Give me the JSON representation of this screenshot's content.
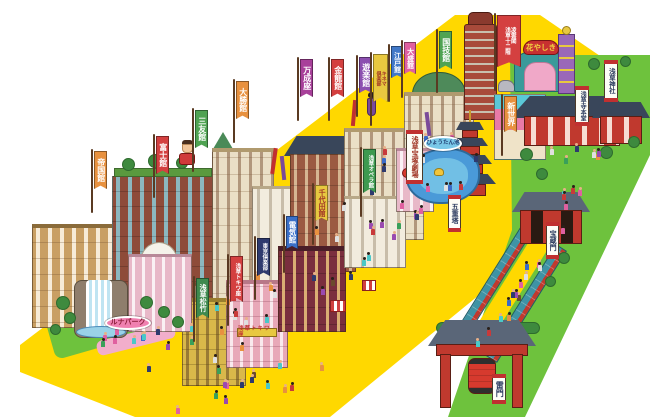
{
  "palette": {
    "plaza": "#FFD800",
    "grass": "#6EC23D",
    "pond": "#4A9AD8",
    "brand_red": "#C0392E"
  },
  "banners": [
    {
      "name": "banner-teikokukan",
      "type": "nobori",
      "label": "帝国館",
      "bg": "#E8913F",
      "fg": "#FFFFFF",
      "x": 94,
      "y": 151,
      "w": 13,
      "h": 38,
      "fs": 8
    },
    {
      "name": "banner-fujikan",
      "type": "nobori",
      "label": "富士館",
      "bg": "#D44040",
      "fg": "#FFFFFF",
      "x": 156,
      "y": 136,
      "w": 13,
      "h": 38,
      "fs": 8
    },
    {
      "name": "banner-sanyukan",
      "type": "nobori",
      "label": "三友館",
      "bg": "#4FA352",
      "fg": "#FFFFFF",
      "x": 195,
      "y": 110,
      "w": 13,
      "h": 38,
      "fs": 8
    },
    {
      "name": "banner-taishokan",
      "type": "nobori",
      "label": "大勝館",
      "bg": "#E8913F",
      "fg": "#FFFFFF",
      "x": 236,
      "y": 81,
      "w": 13,
      "h": 38,
      "fs": 8
    },
    {
      "name": "banner-manseiza",
      "type": "nobori",
      "label": "万成座",
      "bg": "#A8409A",
      "fg": "#FFFFFF",
      "x": 300,
      "y": 59,
      "w": 13,
      "h": 38,
      "fs": 8
    },
    {
      "name": "banner-kinryukan",
      "type": "nobori",
      "label": "金龍館",
      "bg": "#D44040",
      "fg": "#FFFFFF",
      "x": 331,
      "y": 59,
      "w": 13,
      "h": 38,
      "fs": 8
    },
    {
      "name": "banner-yurakukan",
      "type": "nobori",
      "label": "遊楽館",
      "bg": "#8C4FB0",
      "fg": "#FFFFFF",
      "x": 359,
      "y": 57,
      "w": 13,
      "h": 36,
      "fs": 8
    },
    {
      "name": "banner-kinema-club",
      "type": "nobori",
      "label": [
        "キネマ",
        "倶楽部"
      ],
      "bg": "#E8C840",
      "fg": "#A03424",
      "x": 373,
      "y": 54,
      "w": 15,
      "h": 48,
      "fs": 5
    },
    {
      "name": "banner-edokan",
      "type": "nobori",
      "label": "江戸館",
      "bg": "#4178C8",
      "fg": "#FFFFFF",
      "x": 391,
      "y": 46,
      "w": 12,
      "h": 32,
      "fs": 7
    },
    {
      "name": "banner-taiseikan",
      "type": "nobori",
      "label": "大盛館",
      "bg": "#E060A0",
      "fg": "#FFFFFF",
      "x": 404,
      "y": 42,
      "w": 12,
      "h": 32,
      "fs": 7
    },
    {
      "name": "banner-kokugikan",
      "type": "nobori",
      "label": "国技館",
      "bg": "#4FA352",
      "fg": "#FFFFFF",
      "x": 439,
      "y": 31,
      "w": 13,
      "h": 38,
      "fs": 8
    },
    {
      "name": "banner-ryounkaku",
      "type": "nobori",
      "label": [
        "凌雲閣",
        "浅草十二階"
      ],
      "bg": "#D44040",
      "fg": "#FFFFFF",
      "x": 497,
      "y": 15,
      "w": 24,
      "h": 52,
      "fs": 5.5
    },
    {
      "name": "banner-shinsekai",
      "type": "nobori",
      "label": "新世界",
      "bg": "#E8913F",
      "fg": "#FFFFFF",
      "x": 504,
      "y": 96,
      "w": 13,
      "h": 36,
      "fs": 8
    },
    {
      "name": "banner-asakusa-operakan",
      "type": "nobori",
      "label": "浅草オペラ館",
      "bg": "#3E9A50",
      "fg": "#FFFFFF",
      "x": 363,
      "y": 149,
      "w": 13,
      "h": 44,
      "fs": 5.5
    },
    {
      "name": "banner-chiyodakan",
      "type": "nobori",
      "label": "千代田館",
      "bg": "#E8C840",
      "fg": "#A03424",
      "x": 315,
      "y": 185,
      "w": 13,
      "h": 36,
      "fs": 7
    },
    {
      "name": "banner-denkikan",
      "type": "nobori",
      "label": "電気館",
      "bg": "#3A6FC8",
      "fg": "#FFFFFF",
      "x": 286,
      "y": 216,
      "w": 12,
      "h": 33,
      "fs": 7.5
    },
    {
      "name": "banner-tokyo-club",
      "type": "nobori",
      "label": "東京倶楽部",
      "bg": "#2E3A6E",
      "fg": "#FFFFFF",
      "x": 257,
      "y": 238,
      "w": 13,
      "h": 38,
      "fs": 5.5
    },
    {
      "name": "banner-asakusa-tokiwaza",
      "type": "nobori",
      "label": "浅草トキワ座",
      "bg": "#D44040",
      "fg": "#FFFFFF",
      "x": 230,
      "y": 256,
      "w": 13,
      "h": 46,
      "fs": 5.5
    },
    {
      "name": "banner-asakusa-shochiku",
      "type": "nobori",
      "label": "浅草松竹",
      "bg": "#3E8A4E",
      "fg": "#FFFFFF",
      "x": 196,
      "y": 278,
      "w": 13,
      "h": 40,
      "fs": 7
    },
    {
      "name": "sign-hanayashiki",
      "type": "arch",
      "label": "花やしき",
      "bg": "#C83030",
      "fg": "#F0D040",
      "x": 523,
      "y": 40,
      "w": 36,
      "h": 15,
      "fs": 7.5
    },
    {
      "name": "plate-asakusa-jinja",
      "type": "plate",
      "label": "浅草神社",
      "x": 604,
      "y": 60,
      "w": 14,
      "h": 42,
      "fs": 6.5
    },
    {
      "name": "plate-sensoji-hondo",
      "type": "plate",
      "label": "浅草寺本堂",
      "x": 575,
      "y": 86,
      "w": 14,
      "h": 40,
      "fs": 6
    },
    {
      "name": "plate-gojunoto",
      "type": "plate",
      "label": "五重塔",
      "x": 448,
      "y": 195,
      "w": 13,
      "h": 37,
      "fs": 7
    },
    {
      "name": "plate-hozomon",
      "type": "plate",
      "label": "宝蔵門",
      "x": 546,
      "y": 222,
      "w": 13,
      "h": 37,
      "fs": 7
    },
    {
      "name": "plate-kaminarimon",
      "type": "plate",
      "label": "雷門",
      "x": 492,
      "y": 374,
      "w": 14,
      "h": 30,
      "fs": 8
    },
    {
      "name": "plate-asakusa-takarazuka",
      "type": "plate",
      "label": "浅草宝塚劇場",
      "fg": "#A03424",
      "x": 406,
      "y": 130,
      "w": 17,
      "h": 54,
      "fs": 7
    },
    {
      "name": "oval-hyotan-ike",
      "type": "oval",
      "label": "ひょうたん池",
      "bg": "#7AC8E8",
      "fg": "#1E3A6E",
      "x": 424,
      "y": 136,
      "w": 38,
      "h": 15,
      "fs": 5.5
    },
    {
      "name": "oval-luna-park",
      "type": "oval",
      "label": "ルナパーク",
      "bg": "#F080B0",
      "fg": "#8A1E3A",
      "x": 105,
      "y": 316,
      "w": 46,
      "h": 14,
      "fs": 7
    },
    {
      "name": "sign-tokiwaza-board",
      "type": "board",
      "label": "浅草トキワ座",
      "bg": "#E8C840",
      "fg": "#C03030",
      "x": 237,
      "y": 328,
      "w": 40,
      "h": 9,
      "fs": 5.5
    }
  ]
}
